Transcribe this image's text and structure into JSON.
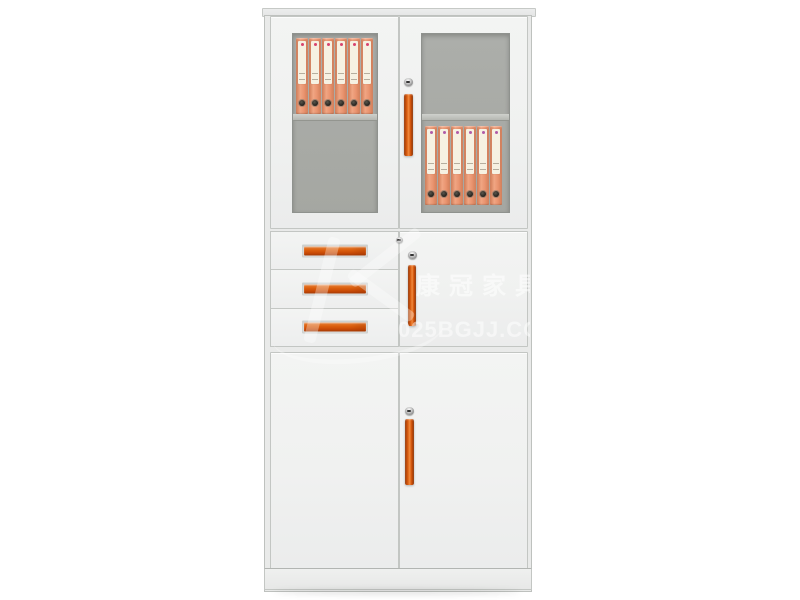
{
  "scene": {
    "description": "Product photo of a white steel office file cabinet on a plain white background",
    "background_color": "#ffffff"
  },
  "watermark": {
    "brand_text": "康冠家具",
    "site_text": "025BGJJ.COM",
    "color": "#ffffff"
  },
  "cabinet": {
    "palette": {
      "body": "#edeeed",
      "door_face": "#f1f2f1",
      "frame_line": "#c3c6c3",
      "glass_interior": "#a7a9a4",
      "shelf_board": "#c6c8c3",
      "handle_orange": "#d85a0d",
      "binder_body": "#e8906c",
      "binder_label": "#f5efe2",
      "binder_dot_left": "#d8436e",
      "binder_dot_right": "#b05ba8",
      "lock_metal": "#8e8e8e"
    },
    "top_section": {
      "type": "double glass doors",
      "left_door": {
        "binder_count": 6,
        "binders_on": "upper shelf"
      },
      "right_door": {
        "binder_count": 6,
        "binders_on": "lower shelf"
      },
      "hardware": [
        "keyhole lock",
        "vertical orange handle"
      ]
    },
    "middle_section": {
      "drawer_count": 3,
      "drawer_hardware": "horizontal orange handle",
      "door_hardware": [
        "keyhole lock",
        "keyhole lock",
        "vertical orange handle"
      ]
    },
    "bottom_section": {
      "type": "double doors",
      "hardware": [
        "keyhole lock",
        "vertical orange handle"
      ]
    }
  }
}
